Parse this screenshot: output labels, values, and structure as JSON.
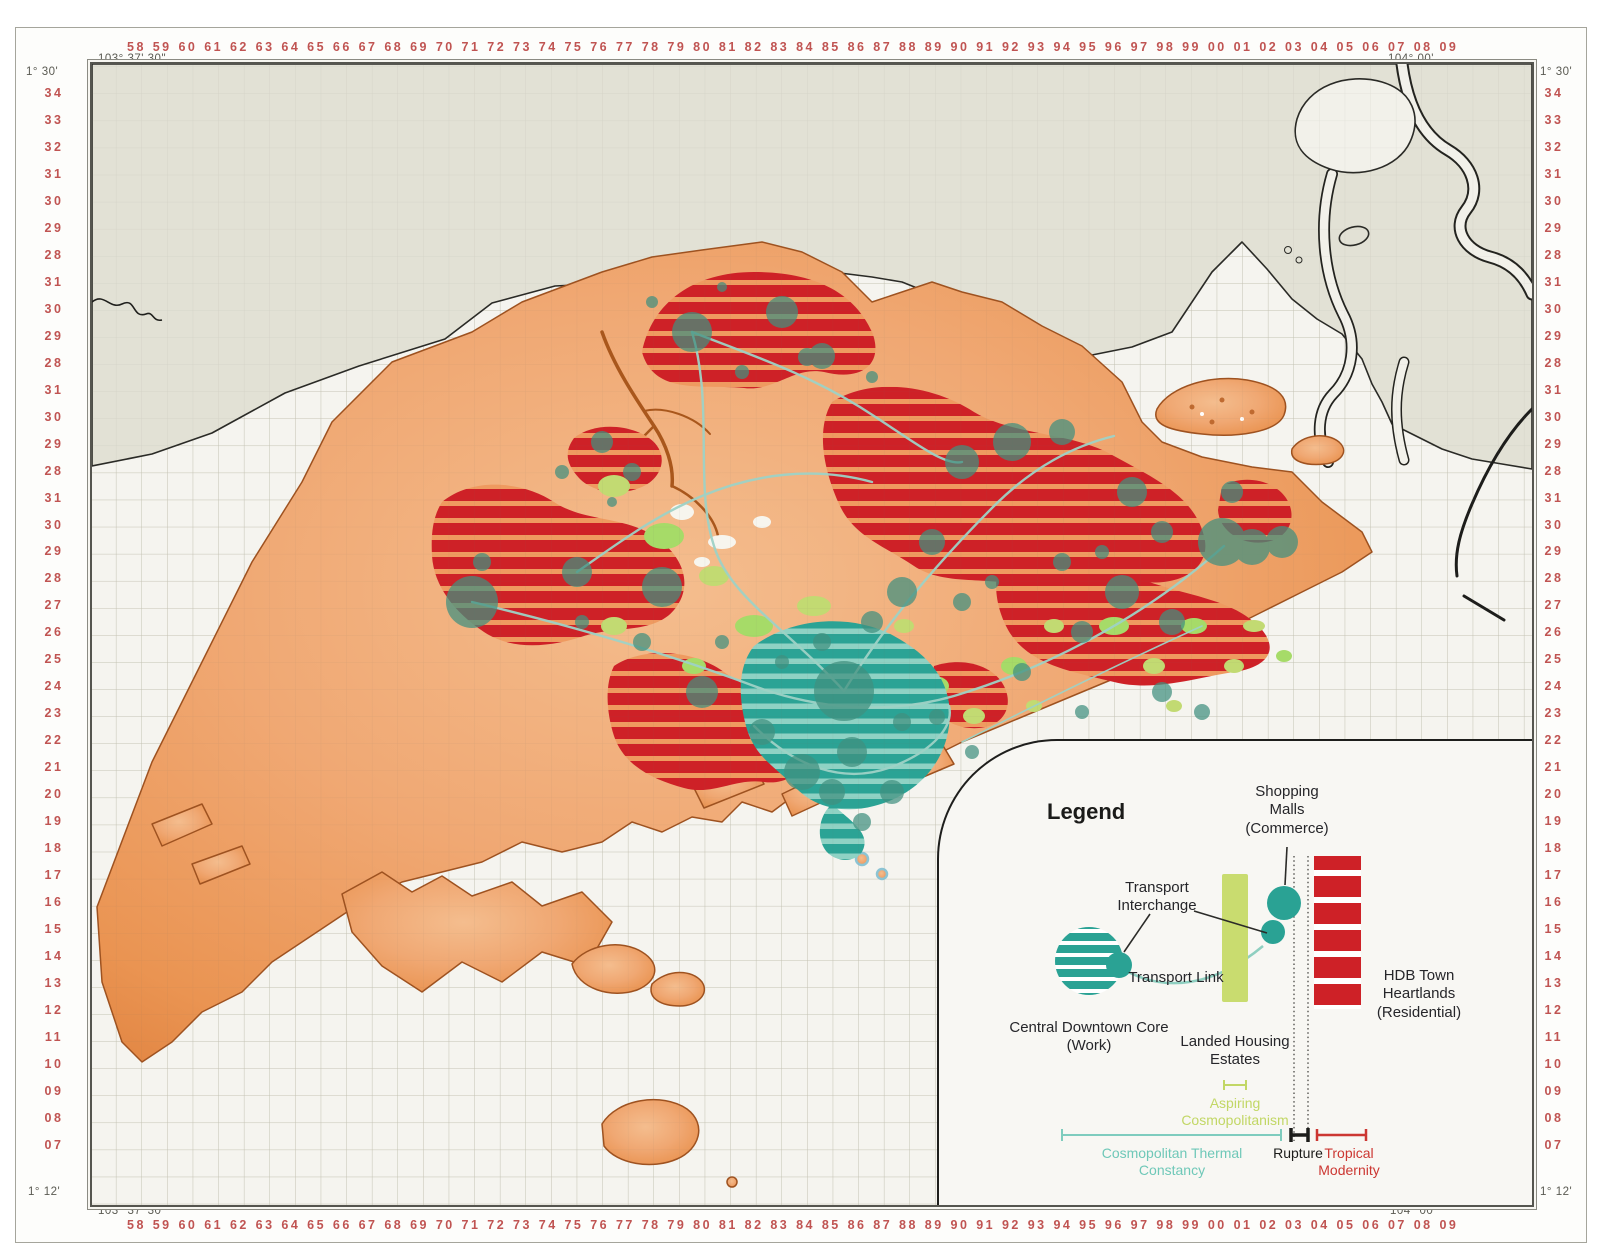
{
  "frame": {
    "lon_label_west": "103° 37' 30\"",
    "lon_label_east": "104° 00'",
    "lat_label_north": "1° 30'",
    "lat_label_south": "1° 12'",
    "x_labels": [
      "58",
      "59",
      "60",
      "61",
      "62",
      "63",
      "64",
      "65",
      "66",
      "67",
      "68",
      "69",
      "70",
      "71",
      "72",
      "73",
      "74",
      "75",
      "76",
      "77",
      "78",
      "79",
      "80",
      "81",
      "82",
      "83",
      "84",
      "85",
      "86",
      "87",
      "88",
      "89",
      "90",
      "91",
      "92",
      "93",
      "94",
      "95",
      "96",
      "97",
      "98",
      "99",
      "00",
      "01",
      "02",
      "03",
      "04",
      "05",
      "06",
      "07",
      "08",
      "09"
    ],
    "y_labels": [
      "34",
      "33",
      "32",
      "31",
      "30",
      "29",
      "28",
      "31",
      "30",
      "29",
      "28",
      "31",
      "30",
      "29",
      "28",
      "31",
      "30",
      "29",
      "28",
      "27",
      "26",
      "25",
      "24",
      "23",
      "22",
      "21",
      "20",
      "19",
      "18",
      "17",
      "16",
      "15",
      "14",
      "13",
      "12",
      "11",
      "10",
      "09",
      "08",
      "07"
    ]
  },
  "legend": {
    "title": "Legend",
    "shopping_malls": "Shopping Malls (Commerce)",
    "transport_interchange": "Transport Interchange",
    "transport_link": "Transport Link",
    "central_downtown_core": "Central Downtown Core (Work)",
    "landed_housing_estates": "Landed Housing Estates",
    "hdb_town_heartlands": "HDB Town Heartlands (Residential)",
    "aspiring_cosmopolitanism": "Aspiring Cosmopolitanism",
    "cosmopolitan_thermal_constancy": "Cosmopolitan Thermal Constancy",
    "rupture": "Rupture",
    "tropical_modernity": "Tropical Modernity"
  },
  "colors": {
    "axis_label": "#c05452",
    "sea": "#f5f4ef",
    "foreign_land_grey": "#e2e1d5",
    "singapore_land_orange": "#efa770",
    "coastline_brown": "#9e5220",
    "hdb_red": "#ce2127",
    "landed_housing_green": "#c9dc6f",
    "downtown_teal": "#2aa294",
    "mall_circle_teal": "#41907f",
    "transport_link_teal": "#9ed2c6",
    "rupture_black": "#1c1c1a",
    "tropical_modernity_red": "#cc3732"
  }
}
